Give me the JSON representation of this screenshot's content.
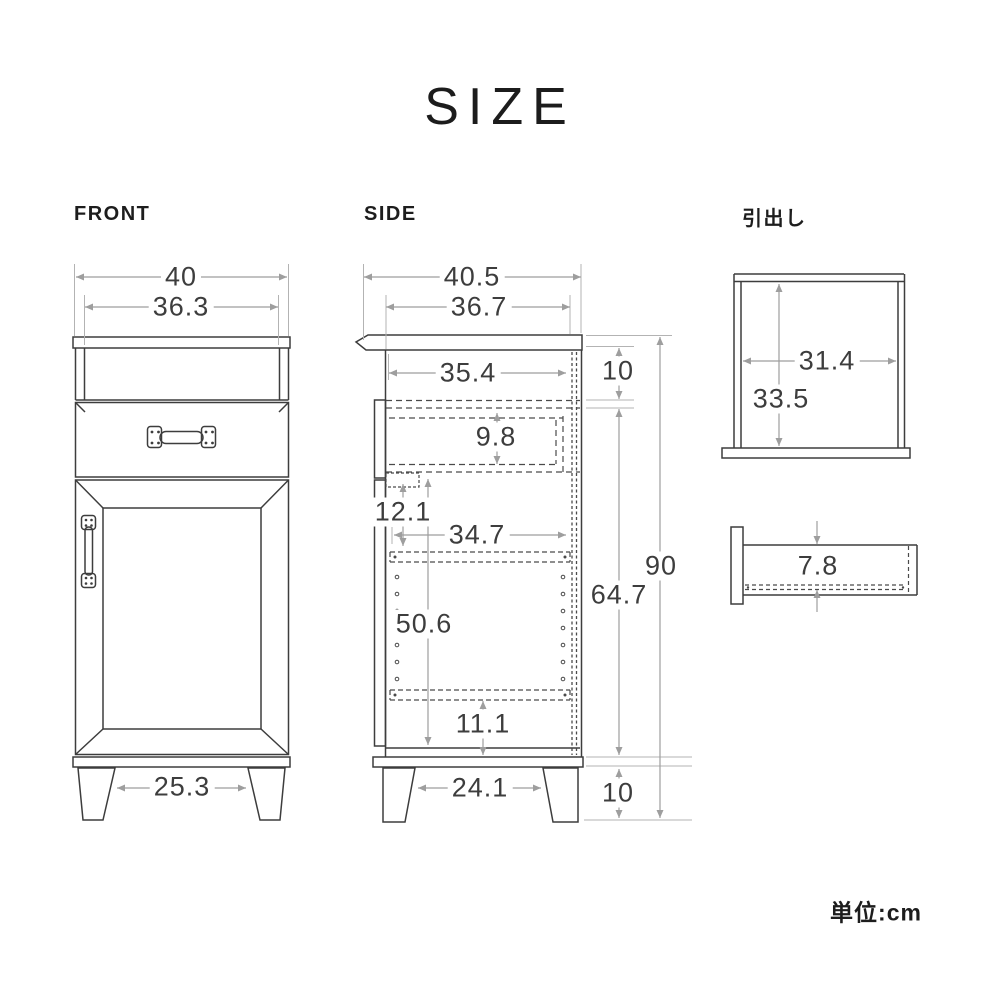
{
  "title": "SIZE",
  "unit": "単位:cm",
  "colors": {
    "line": "#3d3d3d",
    "hidden_line": "#4a4a4a",
    "dimension": "#9e9e9e",
    "text": "#3d3d3d"
  },
  "views": {
    "front": {
      "label": "FRONT",
      "dims": {
        "overall_width": "40",
        "body_width": "36.3",
        "leg_span": "25.3"
      }
    },
    "side": {
      "label": "SIDE",
      "dims": {
        "overall_depth": "40.5",
        "top_depth": "36.7",
        "inner_depth": "35.4",
        "top_shelf_height": "10",
        "drawer_cavity_height": "9.8",
        "door_top_offset": "12.1",
        "shelf_depth": "34.7",
        "door_cavity_height": "50.6",
        "body_height": "64.7",
        "overall_height": "90",
        "bottom_offset": "11.1",
        "leg_span": "24.1",
        "leg_height": "10"
      }
    },
    "drawer": {
      "label": "引出し",
      "dims": {
        "inner_width": "31.4",
        "inner_depth": "33.5",
        "inner_height": "7.8"
      }
    }
  }
}
